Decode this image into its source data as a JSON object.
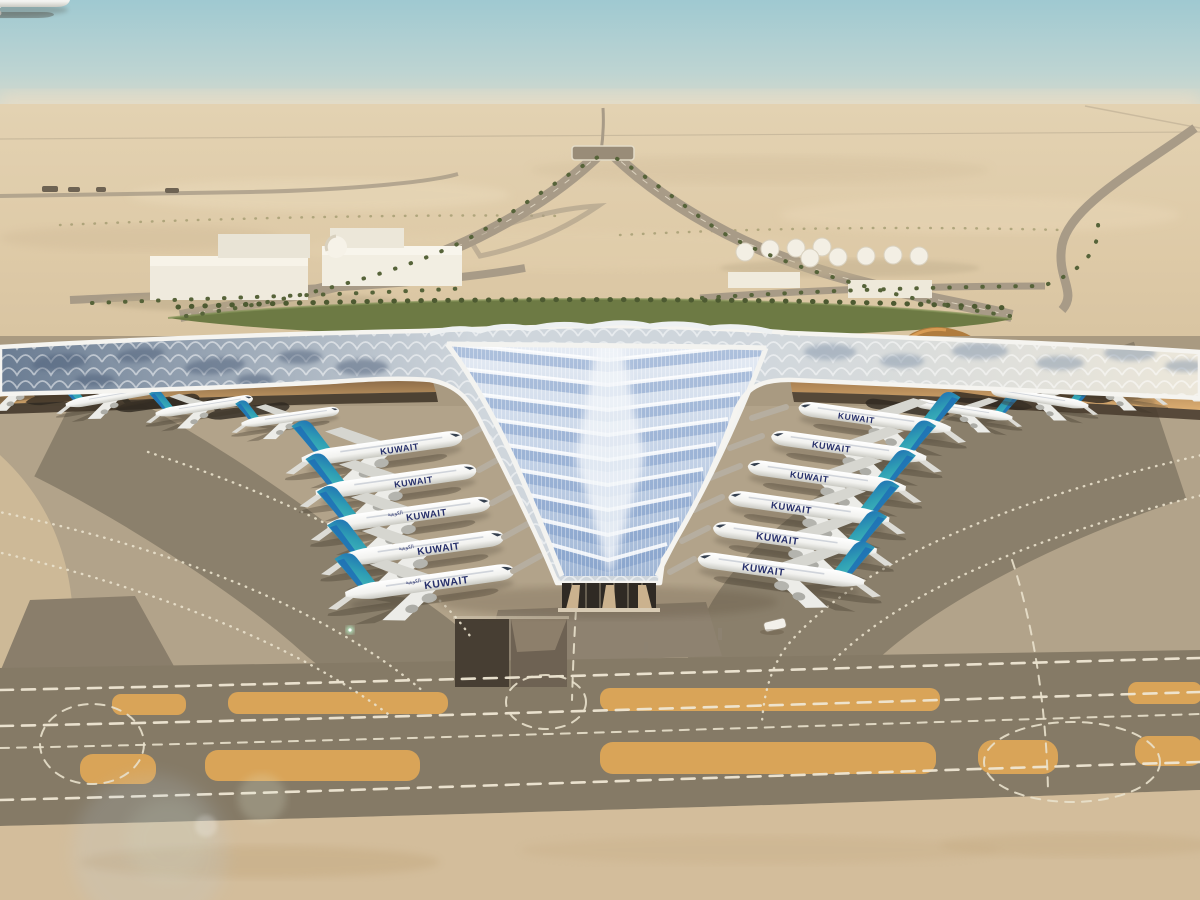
{
  "scene": {
    "title": "Kuwait International Airport new terminal – aerial architectural rendering",
    "setting": "desert airport campus under a pale hazy sky",
    "view": "high oblique aerial view of a trefoil-roof terminal with aircraft at gates",
    "time_of_day": "hazy daylight with soft lens flare"
  },
  "terminal": {
    "roof_style": "swooping three-winged lattice roof with blue chevron skylights",
    "wings": [
      "left pier",
      "right pier",
      "central pier toward viewer"
    ],
    "facade": "glazed gable at central pier tip with tapered stone columns",
    "soffit": "warm amber underside canopy over the gates"
  },
  "aircraft": {
    "airline_label": "KUWAIT",
    "airline_label_arabic": "الكويتية",
    "livery": {
      "fuselage": "#f5f5f2",
      "tail_teal": "#38b2b2",
      "tail_blue": "#1f6fb5",
      "wordmark_navy": "#27306b"
    },
    "parked_left_of_central_pier": 5,
    "parked_right_of_central_pier": 6,
    "parked_under_side_piers": 8
  },
  "airfield": {
    "taxiway_markings": "white dashed guide lines",
    "shoulder_strips": "orange painted strips",
    "features": [
      "curved dual taxiways",
      "parallel taxiway corridor",
      "sunken service road",
      "ground vehicles",
      "aircraft shadows"
    ]
  },
  "background": {
    "left_buildings": "white cargo warehouses with a small dome",
    "right_buildings": "fuel tank farm and warehouses",
    "vegetation": "palm-lined approach roads and a green landscaped median",
    "roads": "V-shaped landside approach converging toward the horizon",
    "landmark": "bronze dune-shaped pavilion beside the approach road"
  },
  "palette": {
    "sky_top": "#a3cbd2",
    "sky_horizon": "#e5dcc7",
    "desert": "#decaa7",
    "apron": "#b2a38a",
    "taxiway_dark": "#867b67",
    "strip_orange": "#d9a458",
    "sand_foreground": "#d3bd9b",
    "roof_silver": "#d3dade",
    "roof_glass_blue": "#8fabd6",
    "green_median": "#6d7a44",
    "soffit_amber": "#c89d66"
  }
}
